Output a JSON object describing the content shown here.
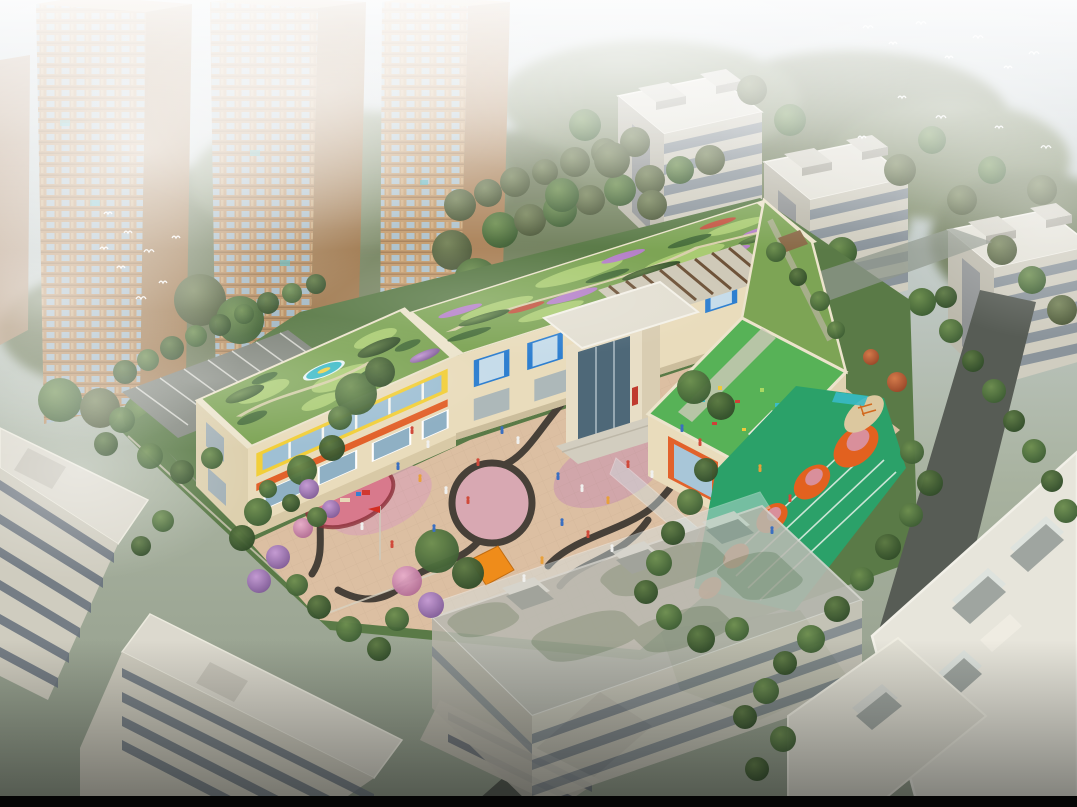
{
  "image": {
    "type": "architectural aerial rendering",
    "subject": "Kindergarten campus with rooftop gardens, central curved plaza, rooftop play deck and sports field with orange circles, surrounded by high-rise towers in fog, white apartment blocks, tree-lined roads and a semi-transparent foreground residential slab",
    "atmosphere": "hazy daylight, white fog over towers, flocks of white birds",
    "sr_description": "Aerial rendering of a U-shaped kindergarten with green roofs and colorful orange, yellow and blue facade panels; a beige plaza with dark S-curved paving bands and a central circle; a red flag; play equipment; a green running track with orange circles; foggy residential towers behind and white apartment slabs around."
  },
  "palette": {
    "sky_top": "#cdd6dd",
    "sky_bottom": "#8e9887",
    "fog": "#ffffff",
    "tower_wall": "#b98f63",
    "tower_window": "#a3b8c4",
    "apartment_wall": "#d0cdc0",
    "apartment_roof": "#e2e0d6",
    "school_wall": "#e9dcbc",
    "accent_yellow": "#f2cf3a",
    "accent_orange": "#e2622b",
    "accent_blue": "#2e7fc2",
    "accent_red": "#c03a2e",
    "roof_garden": "#7da455",
    "play_roof": "#57b257",
    "plaza": "#dcbfa2",
    "plaza_pink": "#d9a9b2",
    "plaza_curve": "#474038",
    "field_green": "#2ba169",
    "field_orange": "#e2611f",
    "sand": "#dcc89f",
    "pool_teal": "#39b9c6",
    "road": "#575c55",
    "ghost_roof": "#b9b9b1",
    "black_bar": "#050505"
  },
  "scene": {
    "people_colors": [
      "#f0f0ee",
      "#d04a3a",
      "#3a6fc0",
      "#e8a03a",
      "#3c4654"
    ],
    "trees_back": [
      [
        460,
        205,
        16,
        "o"
      ],
      [
        488,
        193,
        14,
        "o"
      ],
      [
        515,
        182,
        15,
        "o"
      ],
      [
        545,
        172,
        13,
        "o"
      ],
      [
        575,
        162,
        15,
        "o"
      ],
      [
        605,
        152,
        14,
        "o"
      ],
      [
        635,
        142,
        15,
        "o"
      ],
      [
        500,
        230,
        18,
        "m"
      ],
      [
        530,
        220,
        16,
        "o"
      ],
      [
        560,
        210,
        17,
        "m"
      ],
      [
        590,
        200,
        15,
        "o"
      ],
      [
        620,
        190,
        16,
        "m"
      ],
      [
        650,
        180,
        15,
        "o"
      ],
      [
        680,
        170,
        14,
        "m"
      ],
      [
        710,
        160,
        15,
        "o"
      ],
      [
        60,
        400,
        22,
        "m"
      ],
      [
        100,
        408,
        20,
        "o"
      ],
      [
        145,
        415,
        22,
        "m"
      ],
      [
        190,
        420,
        20,
        "o"
      ],
      [
        235,
        415,
        21,
        "m"
      ],
      [
        280,
        405,
        19,
        "o"
      ],
      [
        320,
        395,
        20,
        "m"
      ],
      [
        360,
        385,
        18,
        "o"
      ],
      [
        400,
        377,
        19,
        "m"
      ],
      [
        435,
        367,
        18,
        "o"
      ],
      [
        468,
        357,
        17,
        "m"
      ],
      [
        200,
        300,
        26,
        "o"
      ],
      [
        240,
        320,
        24,
        "m"
      ],
      [
        452,
        250,
        20,
        "o"
      ],
      [
        476,
        280,
        22,
        "m"
      ],
      [
        505,
        310,
        20,
        "o"
      ],
      [
        585,
        125,
        16,
        "m"
      ],
      [
        612,
        160,
        18,
        "o"
      ],
      [
        562,
        195,
        17,
        "m"
      ],
      [
        652,
        205,
        15,
        "o"
      ],
      [
        752,
        90,
        15,
        "o"
      ],
      [
        790,
        120,
        16,
        "m"
      ],
      [
        762,
        250,
        18,
        "m"
      ],
      [
        800,
        280,
        17,
        "o"
      ],
      [
        842,
        252,
        15,
        "m"
      ],
      [
        900,
        170,
        16,
        "o"
      ],
      [
        932,
        140,
        14,
        "m"
      ],
      [
        962,
        200,
        15,
        "o"
      ],
      [
        992,
        170,
        14,
        "m"
      ],
      [
        1042,
        190,
        15,
        "o"
      ],
      [
        862,
        300,
        16,
        "m"
      ],
      [
        892,
        330,
        15,
        "o"
      ],
      [
        922,
        302,
        14,
        "m"
      ],
      [
        1002,
        250,
        15,
        "o"
      ],
      [
        1032,
        280,
        14,
        "m"
      ],
      [
        1062,
        310,
        15,
        "o"
      ]
    ],
    "trees_front": [
      [
        125,
        372,
        12,
        "d"
      ],
      [
        148,
        360,
        11,
        "m"
      ],
      [
        172,
        348,
        12,
        "d"
      ],
      [
        196,
        336,
        11,
        "m"
      ],
      [
        220,
        325,
        11,
        "d"
      ],
      [
        244,
        314,
        10,
        "m"
      ],
      [
        268,
        303,
        11,
        "d"
      ],
      [
        292,
        293,
        10,
        "m"
      ],
      [
        316,
        284,
        10,
        "d"
      ],
      [
        122,
        420,
        13,
        "m"
      ],
      [
        106,
        444,
        12,
        "d"
      ],
      [
        150,
        456,
        13,
        "m"
      ],
      [
        182,
        472,
        12,
        "d"
      ],
      [
        212,
        458,
        11,
        "m"
      ],
      [
        302,
        470,
        15,
        "m"
      ],
      [
        332,
        448,
        13,
        "d"
      ],
      [
        356,
        394,
        21,
        "m"
      ],
      [
        380,
        372,
        15,
        "d"
      ],
      [
        340,
        418,
        12,
        "m"
      ],
      [
        258,
        512,
        14,
        "m"
      ],
      [
        242,
        538,
        13,
        "d"
      ],
      [
        278,
        557,
        12,
        "p"
      ],
      [
        259,
        581,
        12,
        "p"
      ],
      [
        297,
        585,
        11,
        "m"
      ],
      [
        319,
        607,
        12,
        "d"
      ],
      [
        349,
        629,
        13,
        "m"
      ],
      [
        379,
        649,
        12,
        "d"
      ],
      [
        303,
        528,
        10,
        "pk"
      ],
      [
        331,
        509,
        9,
        "p"
      ],
      [
        309,
        489,
        10,
        "p"
      ],
      [
        437,
        551,
        22,
        "m"
      ],
      [
        468,
        573,
        16,
        "d"
      ],
      [
        407,
        581,
        15,
        "pk"
      ],
      [
        431,
        605,
        13,
        "p"
      ],
      [
        397,
        619,
        12,
        "m"
      ],
      [
        694,
        387,
        17,
        "m"
      ],
      [
        721,
        406,
        14,
        "d"
      ],
      [
        268,
        489,
        9,
        "m"
      ],
      [
        291,
        503,
        9,
        "d"
      ],
      [
        317,
        517,
        10,
        "m"
      ],
      [
        776,
        252,
        10,
        "m"
      ],
      [
        798,
        277,
        9,
        "d"
      ],
      [
        820,
        301,
        10,
        "m"
      ],
      [
        836,
        330,
        9,
        "m"
      ],
      [
        706,
        470,
        12,
        "d"
      ],
      [
        690,
        502,
        13,
        "m"
      ],
      [
        673,
        533,
        12,
        "d"
      ],
      [
        659,
        563,
        13,
        "m"
      ],
      [
        646,
        592,
        12,
        "d"
      ],
      [
        669,
        617,
        13,
        "m"
      ],
      [
        701,
        639,
        14,
        "d"
      ],
      [
        737,
        629,
        12,
        "m"
      ],
      [
        912,
        452,
        12,
        "m"
      ],
      [
        930,
        483,
        13,
        "d"
      ],
      [
        911,
        515,
        12,
        "m"
      ],
      [
        888,
        547,
        13,
        "d"
      ],
      [
        862,
        579,
        12,
        "m"
      ],
      [
        837,
        609,
        13,
        "d"
      ],
      [
        811,
        639,
        14,
        "m"
      ],
      [
        785,
        663,
        12,
        "d"
      ],
      [
        897,
        382,
        10,
        "r"
      ],
      [
        871,
        357,
        8,
        "r"
      ],
      [
        951,
        331,
        12,
        "m"
      ],
      [
        973,
        361,
        11,
        "d"
      ],
      [
        994,
        391,
        12,
        "m"
      ],
      [
        1014,
        421,
        11,
        "d"
      ],
      [
        1034,
        451,
        12,
        "m"
      ],
      [
        1052,
        481,
        11,
        "d"
      ],
      [
        1066,
        511,
        12,
        "m"
      ],
      [
        946,
        297,
        11,
        "d"
      ],
      [
        766,
        691,
        13,
        "m"
      ],
      [
        745,
        717,
        12,
        "d"
      ],
      [
        783,
        739,
        13,
        "m"
      ],
      [
        757,
        769,
        12,
        "d"
      ],
      [
        163,
        521,
        11,
        "m"
      ],
      [
        141,
        546,
        10,
        "d"
      ]
    ],
    "people": [
      [
        412,
        432,
        1
      ],
      [
        428,
        446,
        0
      ],
      [
        398,
        468,
        2
      ],
      [
        420,
        480,
        3
      ],
      [
        446,
        492,
        0
      ],
      [
        468,
        502,
        1
      ],
      [
        502,
        432,
        2
      ],
      [
        518,
        442,
        0
      ],
      [
        478,
        464,
        1
      ],
      [
        558,
        478,
        2
      ],
      [
        582,
        490,
        0
      ],
      [
        608,
        502,
        3
      ],
      [
        628,
        466,
        1
      ],
      [
        652,
        476,
        0
      ],
      [
        562,
        524,
        2
      ],
      [
        588,
        536,
        1
      ],
      [
        612,
        550,
        0
      ],
      [
        542,
        562,
        3
      ],
      [
        434,
        530,
        2
      ],
      [
        392,
        546,
        1
      ],
      [
        362,
        528,
        0
      ],
      [
        682,
        430,
        2
      ],
      [
        700,
        444,
        1
      ],
      [
        524,
        580,
        0
      ],
      [
        760,
        470,
        3
      ],
      [
        790,
        500,
        1
      ],
      [
        772,
        532,
        2
      ]
    ],
    "birds": [
      [
        868,
        28,
        5
      ],
      [
        893,
        44,
        4
      ],
      [
        921,
        24,
        5
      ],
      [
        949,
        58,
        4
      ],
      [
        978,
        38,
        5
      ],
      [
        1008,
        68,
        4
      ],
      [
        1034,
        54,
        5
      ],
      [
        902,
        98,
        4
      ],
      [
        941,
        118,
        5
      ],
      [
        999,
        128,
        4
      ],
      [
        862,
        138,
        4
      ],
      [
        1046,
        148,
        5
      ],
      [
        108,
        214,
        4
      ],
      [
        128,
        233,
        4
      ],
      [
        149,
        252,
        5
      ],
      [
        121,
        268,
        4
      ],
      [
        163,
        283,
        4
      ],
      [
        141,
        299,
        5
      ],
      [
        104,
        249,
        4
      ],
      [
        176,
        238,
        4
      ]
    ]
  }
}
